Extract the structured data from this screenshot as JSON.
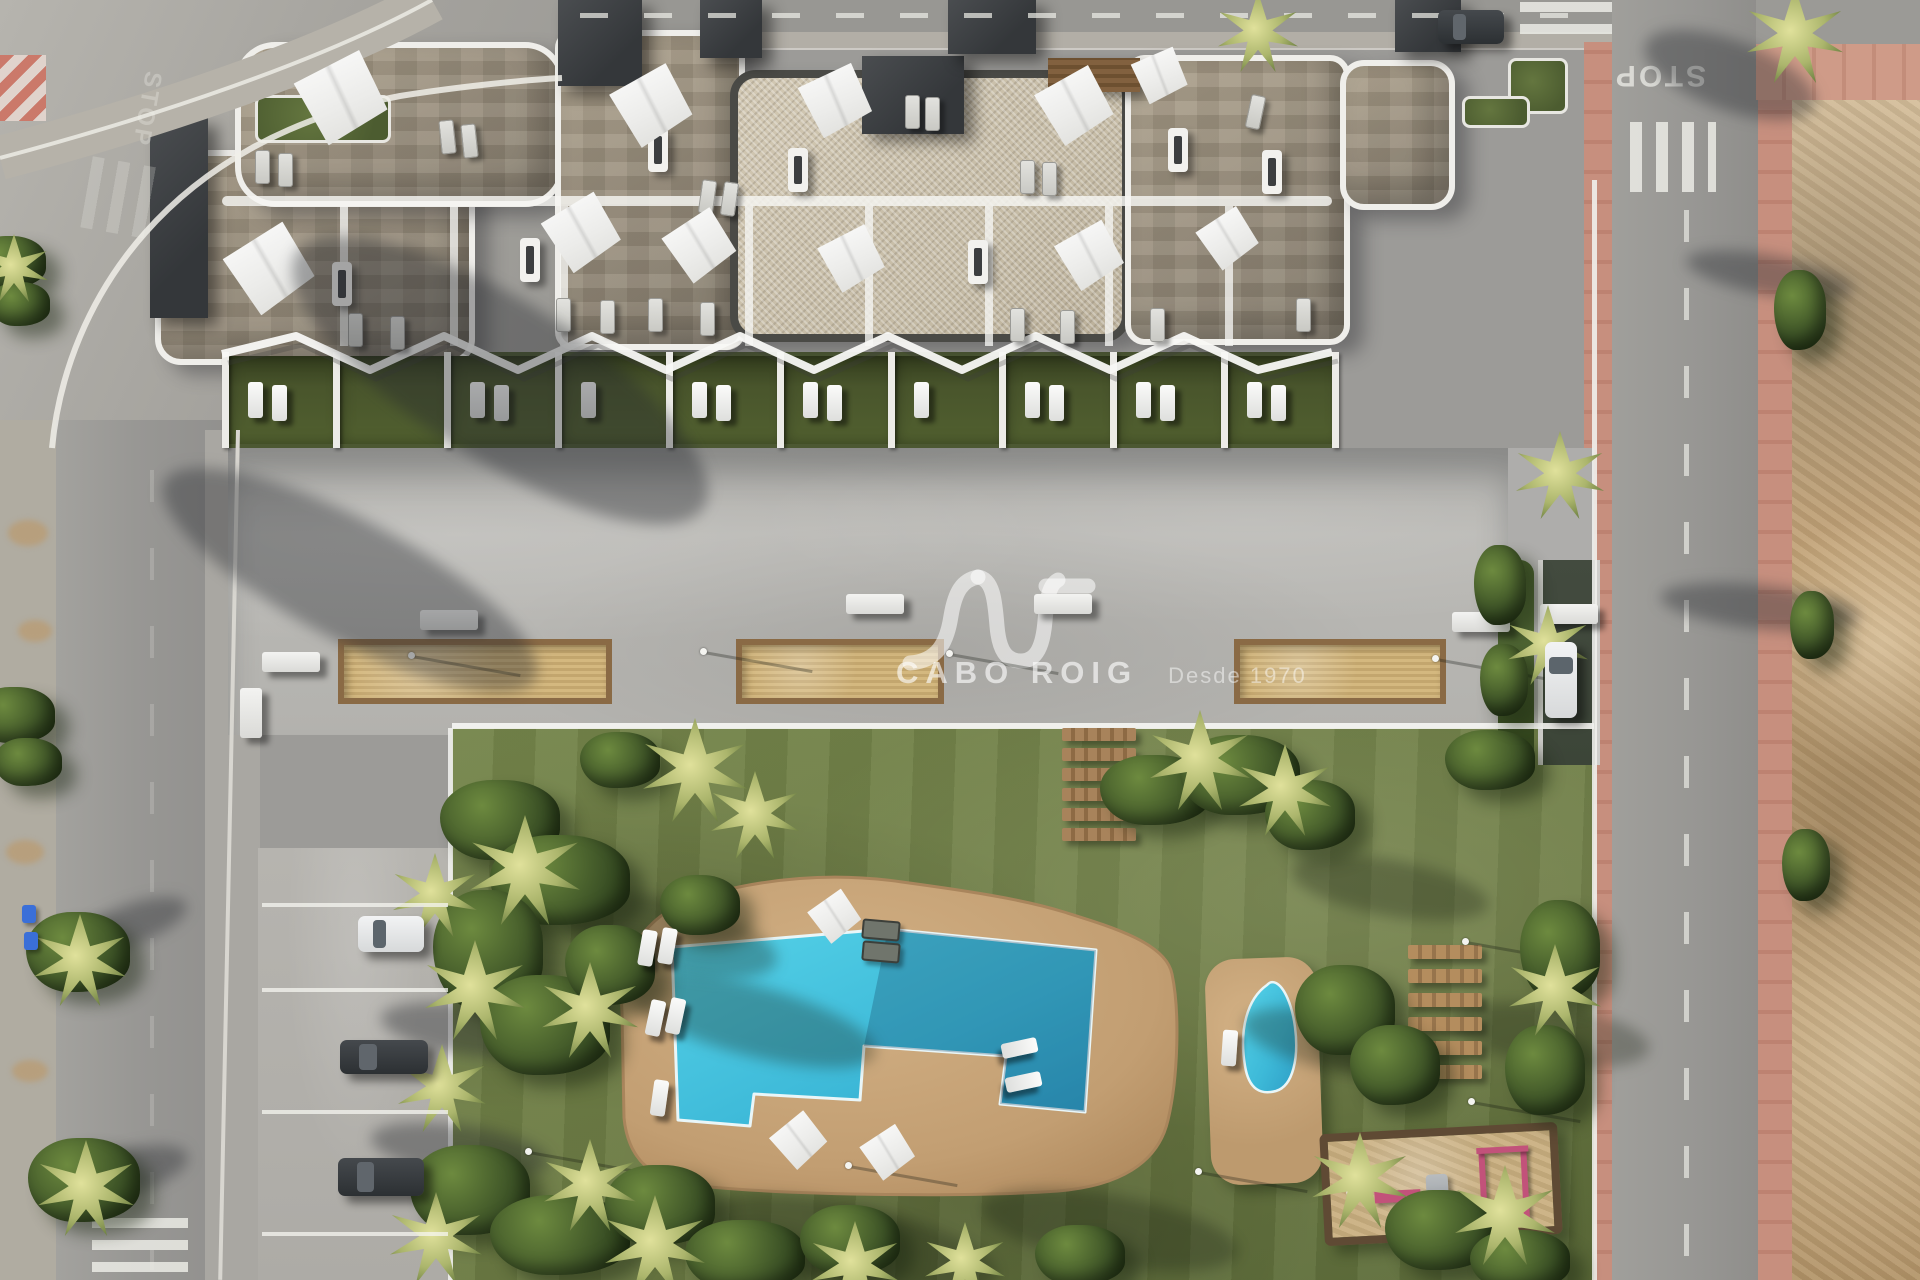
{
  "meta": {
    "scene": "aerial-architectural-render-of-apartment-complex-with-pool-garden"
  },
  "watermark": {
    "brand": "CABO ROIG",
    "tagline": "Desde 1970",
    "logo": "AV-monogram"
  },
  "road": {
    "stop_text": "STOP"
  },
  "palette": {
    "grass": "#75854b",
    "grassDark": "#5d6c3a",
    "pool": "#49c9e2",
    "poolDeep": "#2b9ec6",
    "deck": "#c9a87c",
    "deckEdge": "#a9855c",
    "concrete": "#b9b8b4",
    "road": "#9c9b98",
    "roadLight": "#b6b4ae",
    "sidewalk": "#b2aea6",
    "pink": "#c78f7e",
    "dirt": "#c0a074",
    "dirtLight": "#d6bf9b",
    "stone": "#a89c87",
    "pebble": "#cdc3ae",
    "white": "#f2f1ee",
    "slab": "#3f4143",
    "gardenGreen": "#4c5832",
    "wood": "#9a7950",
    "sand": "#c9b183",
    "carDark": "#34383b",
    "carWhite": "#e7e8e9",
    "rampGreen": "#3c4538",
    "bush": "#3c5226",
    "palm": "#abb56c",
    "playEquip": "#c2527a",
    "binBlue": "#3a6fd8"
  },
  "paths": {
    "pool_deck": "M 622 1012 C 618 958 642 914 702 896 C 766 878 834 872 902 882 C 968 891 1022 899 1064 912 C 1112 927 1166 943 1172 974 C 1180 1012 1178 1078 1168 1120 C 1158 1164 1118 1186 1058 1191 C 976 1197 798 1196 700 1186 C 650 1181 628 1158 624 1118 Z",
    "pool": "M 672 947 L 888 929 L 1096 950 L 1085 1112 L 1000 1104 L 1006 1056 L 864 1046 L 860 1100 L 754 1094 L 750 1126 L 678 1120 Z",
    "pool_shade": "M 888 929 L 1096 950 L 1085 1112 L 1000 1104 L 1006 1056 L 864 1046 Z",
    "small_pool": "M 1267 985 C 1247 999 1239 1030 1245 1066 C 1249 1090 1261 1095 1276 1091 C 1293 1086 1299 1058 1295 1027 C 1292 1004 1284 987 1276 983 C 1271 981 1269 983 1267 985 Z",
    "logo": [
      "M 910 663 C 938 661 947 642 951 616 C 955 592 962 580 978 577",
      "M 978 577 C 993 579 995 601 997 626 C 999 650 1006 661 1021 661 C 1037 661 1043 645 1045 621 C 1047 598 1049 585 1058 580",
      "M 1046 586 L 1088 586"
    ],
    "pergola": "222,354 296,336 370,370 444,336 518,370 592,336 666,370 740,336 814,370 888,336 962,370 1036,336 1110,370 1184,336 1258,370 1332,352",
    "curb": "M 52 448 C 66 300 170 140 400 96 C 450 88 520 80 562 78",
    "sidewalk_arc": "M 0 158 C 150 118 320 62 432 0"
  },
  "building": {
    "wings": [
      [
        155,
        150,
        320,
        215,
        "stone",
        26
      ],
      [
        235,
        42,
        330,
        165,
        "stone",
        40
      ],
      [
        555,
        30,
        190,
        320,
        "stone",
        18
      ],
      [
        730,
        70,
        400,
        272,
        "pebble",
        26
      ],
      [
        1125,
        55,
        225,
        290,
        "stone",
        20
      ],
      [
        1340,
        60,
        115,
        150,
        "stone",
        24
      ]
    ],
    "green_roofs": [
      [
        255,
        95,
        130,
        42
      ],
      [
        1508,
        58,
        54,
        50
      ],
      [
        1462,
        96,
        62,
        26
      ]
    ],
    "dark_slabs": [
      [
        558,
        0,
        84,
        86
      ],
      [
        700,
        0,
        62,
        58
      ],
      [
        862,
        56,
        102,
        78
      ],
      [
        948,
        0,
        88,
        54
      ],
      [
        150,
        118,
        58,
        200
      ],
      [
        1395,
        0,
        66,
        52
      ]
    ],
    "wood_pergola": [
      1048,
      58,
      92,
      34
    ],
    "row_dividers": [
      340,
      450,
      560,
      745,
      865,
      985,
      1105,
      1225
    ],
    "chimneys": [
      [
        648,
        128
      ],
      [
        788,
        148
      ],
      [
        520,
        238
      ],
      [
        968,
        240
      ],
      [
        1168,
        128
      ],
      [
        332,
        262
      ],
      [
        1262,
        150
      ]
    ],
    "sails": [
      [
        342,
        97,
        100,
        20
      ],
      [
        270,
        268,
        96,
        15
      ],
      [
        652,
        105,
        88,
        18
      ],
      [
        836,
        100,
        80,
        22
      ],
      [
        582,
        232,
        84,
        16
      ],
      [
        700,
        245,
        78,
        14
      ],
      [
        852,
        258,
        72,
        20
      ],
      [
        1075,
        105,
        84,
        18
      ],
      [
        1160,
        75,
        62,
        24
      ],
      [
        1090,
        255,
        74,
        18
      ],
      [
        1228,
        238,
        66,
        14
      ]
    ],
    "roof_loungers": [
      [
        700,
        180,
        8
      ],
      [
        722,
        182,
        8
      ],
      [
        905,
        95,
        0
      ],
      [
        925,
        97,
        0
      ],
      [
        1020,
        160,
        0
      ],
      [
        1042,
        162,
        0
      ],
      [
        440,
        120,
        -6
      ],
      [
        462,
        124,
        -6
      ],
      [
        255,
        150,
        0
      ],
      [
        278,
        153,
        0
      ],
      [
        556,
        298,
        0
      ],
      [
        600,
        300,
        0
      ],
      [
        648,
        298,
        0
      ],
      [
        700,
        302,
        0
      ],
      [
        348,
        313,
        0
      ],
      [
        390,
        316,
        0
      ],
      [
        1010,
        308,
        0
      ],
      [
        1060,
        310,
        0
      ],
      [
        1150,
        308,
        0
      ],
      [
        1296,
        298,
        0
      ],
      [
        1248,
        95,
        12
      ]
    ]
  },
  "private_gardens": {
    "dividers": [
      222,
      333,
      444,
      555,
      666,
      777,
      888,
      999,
      1110,
      1221,
      1332
    ],
    "loungers_per_unit": [
      2,
      0,
      2,
      1,
      2,
      2,
      1,
      2,
      2,
      2
    ]
  },
  "terrace": {
    "planters": [
      [
        338,
        639,
        274,
        65
      ],
      [
        736,
        639,
        208,
        65
      ],
      [
        1234,
        639,
        212,
        65
      ]
    ],
    "benches": [
      [
        420,
        610,
        58,
        20
      ],
      [
        846,
        594,
        58,
        20
      ],
      [
        1034,
        594,
        58,
        20
      ],
      [
        262,
        652,
        58,
        20
      ],
      [
        240,
        688,
        22,
        50
      ],
      [
        1452,
        612,
        58,
        20
      ],
      [
        1540,
        604,
        58,
        20
      ]
    ],
    "lamps": [
      [
        408,
        652
      ],
      [
        700,
        648
      ],
      [
        946,
        650
      ],
      [
        1432,
        655
      ]
    ]
  },
  "pool_area": {
    "small_deck": [
      1208,
      958,
      112,
      226,
      -2
    ],
    "parasols": [
      [
        835,
        916,
        56,
        12
      ],
      [
        799,
        1140,
        60,
        8
      ],
      [
        888,
        1152,
        58,
        14
      ]
    ],
    "loungers": [
      [
        640,
        930,
        10
      ],
      [
        660,
        928,
        10
      ],
      [
        648,
        1000,
        12
      ],
      [
        668,
        998,
        12
      ],
      [
        652,
        1080,
        8
      ],
      [
        1012,
        1030,
        78
      ],
      [
        1016,
        1064,
        78
      ],
      [
        1222,
        1030,
        4
      ]
    ],
    "dark_loungers": [
      [
        862,
        920,
        5
      ],
      [
        862,
        942,
        5
      ]
    ]
  },
  "garden": {
    "steps": {
      "x": 1062,
      "y": 728,
      "w": 74,
      "h": 13,
      "gap": 7,
      "count": 6
    },
    "platforms": {
      "x": 1408,
      "y": 945,
      "w": 74,
      "h": 14,
      "gap": 10,
      "count": 6
    },
    "playground": {
      "x": 1322,
      "y": 1128,
      "w": 238,
      "h": 112,
      "rot": -3
    },
    "lamps": [
      [
        525,
        1148
      ],
      [
        845,
        1162
      ],
      [
        1195,
        1168
      ],
      [
        1462,
        938
      ],
      [
        1468,
        1098
      ]
    ],
    "bushes": [
      [
        500,
        820,
        60,
        40
      ],
      [
        560,
        880,
        70,
        45
      ],
      [
        488,
        950,
        55,
        60
      ],
      [
        545,
        1025,
        65,
        50
      ],
      [
        610,
        965,
        45,
        40
      ],
      [
        700,
        905,
        40,
        30
      ],
      [
        1155,
        790,
        55,
        35
      ],
      [
        1240,
        775,
        60,
        40
      ],
      [
        1310,
        815,
        45,
        35
      ],
      [
        1345,
        1010,
        50,
        45
      ],
      [
        1395,
        1065,
        45,
        40
      ],
      [
        470,
        1190,
        60,
        45
      ],
      [
        560,
        1235,
        70,
        40
      ],
      [
        660,
        1205,
        55,
        40
      ],
      [
        745,
        1255,
        60,
        35
      ],
      [
        850,
        1240,
        50,
        35
      ],
      [
        1080,
        1255,
        45,
        30
      ],
      [
        1440,
        1230,
        55,
        40
      ],
      [
        1520,
        1260,
        50,
        30
      ],
      [
        1560,
        950,
        40,
        50
      ],
      [
        1545,
        1070,
        40,
        45
      ],
      [
        620,
        760,
        40,
        28
      ],
      [
        1490,
        760,
        45,
        30
      ]
    ],
    "palms": [
      [
        525,
        870,
        55
      ],
      [
        475,
        990,
        50
      ],
      [
        590,
        1010,
        48
      ],
      [
        695,
        770,
        52
      ],
      [
        755,
        815,
        44
      ],
      [
        1200,
        760,
        50
      ],
      [
        1285,
        790,
        46
      ],
      [
        655,
        1245,
        50
      ],
      [
        590,
        1185,
        46
      ],
      [
        1360,
        1180,
        48
      ],
      [
        1505,
        1215,
        50
      ],
      [
        1555,
        990,
        46
      ],
      [
        435,
        895,
        42
      ],
      [
        442,
        1088,
        44
      ],
      [
        436,
        1238,
        46
      ],
      [
        855,
        1265,
        44
      ],
      [
        965,
        1262,
        40
      ]
    ],
    "tree_shadows": [
      [
        620,
        985,
        260,
        70,
        15
      ],
      [
        700,
        1205,
        300,
        80,
        12
      ],
      [
        980,
        1195,
        260,
        70,
        10
      ],
      [
        1240,
        1015,
        220,
        60,
        12
      ],
      [
        1450,
        1005,
        200,
        60,
        8
      ],
      [
        560,
        900,
        220,
        70,
        14
      ],
      [
        1290,
        860,
        200,
        56,
        10
      ]
    ]
  },
  "street_green": {
    "bushes": [
      [
        15,
        715,
        40,
        28
      ],
      [
        28,
        762,
        34,
        24
      ],
      [
        78,
        952,
        52,
        40
      ],
      [
        84,
        1180,
        56,
        42
      ],
      [
        10,
        262,
        36,
        26
      ],
      [
        20,
        304,
        30,
        22
      ],
      [
        1500,
        585,
        26,
        40
      ],
      [
        1504,
        680,
        24,
        36
      ],
      [
        1800,
        310,
        26,
        40
      ],
      [
        1812,
        625,
        22,
        34
      ],
      [
        1806,
        865,
        24,
        36
      ]
    ],
    "palms": [
      [
        80,
        960,
        46
      ],
      [
        86,
        1188,
        48
      ],
      [
        14,
        268,
        34
      ],
      [
        1795,
        35,
        48
      ],
      [
        1258,
        32,
        40
      ],
      [
        1560,
        475,
        44
      ],
      [
        1548,
        645,
        40
      ]
    ],
    "bins": [
      [
        22,
        905
      ],
      [
        24,
        932
      ]
    ]
  },
  "parking": {
    "lines": [
      903,
      988,
      1110,
      1232
    ],
    "cars": [
      [
        358,
        916,
        66,
        36,
        "white"
      ],
      [
        340,
        1040,
        88,
        34,
        "dark"
      ],
      [
        338,
        1158,
        86,
        38,
        "dark"
      ]
    ]
  },
  "street": {
    "cars": [
      [
        1438,
        10,
        66,
        34,
        "dark"
      ],
      [
        1545,
        642,
        32,
        76,
        "white"
      ]
    ],
    "shadows": [
      [
        260,
        300,
        480,
        160,
        32
      ],
      [
        140,
        520,
        420,
        120,
        28
      ],
      [
        70,
        905,
        120,
        40,
        -20
      ],
      [
        60,
        1150,
        130,
        45,
        -15
      ],
      [
        380,
        1005,
        180,
        50,
        8
      ],
      [
        370,
        1125,
        180,
        50,
        8
      ],
      [
        1660,
        585,
        200,
        44,
        6
      ],
      [
        1685,
        255,
        170,
        40,
        10
      ],
      [
        1640,
        40,
        180,
        70,
        20
      ]
    ]
  }
}
